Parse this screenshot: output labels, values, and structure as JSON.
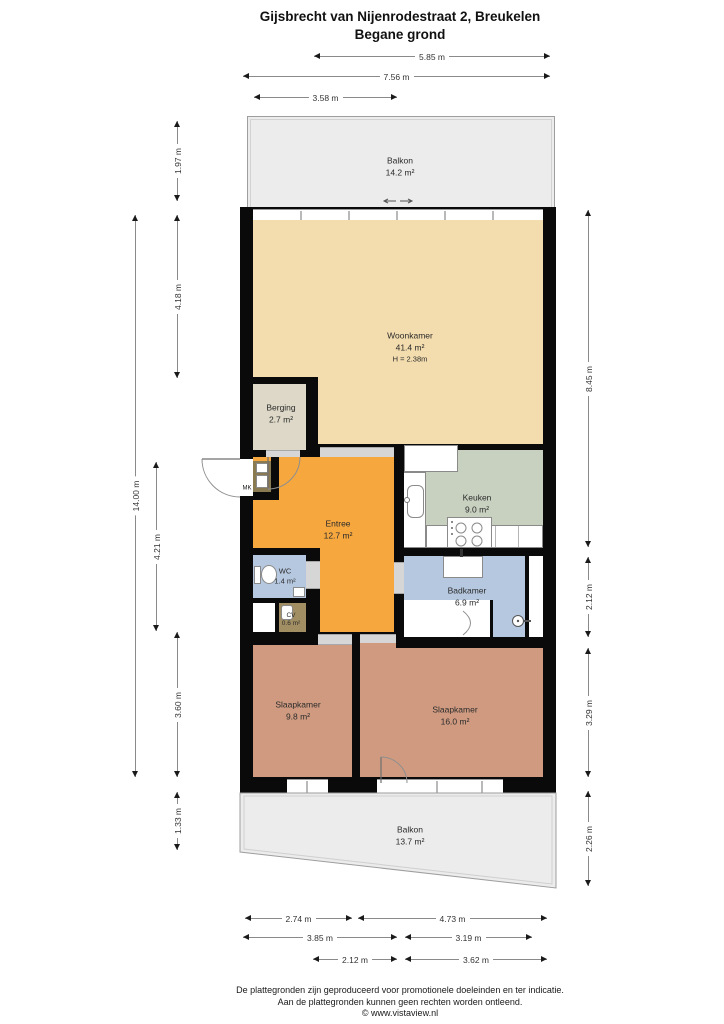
{
  "title": {
    "line1": "Gijsbrecht van Nijenrodestraat 2, Breukelen",
    "line2": "Begane grond"
  },
  "rooms": {
    "balkon_boven": {
      "name": "Balkon",
      "area": "14.2 m²"
    },
    "woonkamer": {
      "name": "Woonkamer",
      "area": "41.4 m²",
      "ceiling": "H = 2.38m"
    },
    "berging": {
      "name": "Berging",
      "area": "2.7 m²"
    },
    "keuken": {
      "name": "Keuken",
      "area": "9.0 m²"
    },
    "entree": {
      "name": "Entree",
      "area": "12.7 m²"
    },
    "wc": {
      "name": "WC",
      "area": "1.4 m²"
    },
    "cv": {
      "name": "CV",
      "area": "0.6 m²"
    },
    "badkamer": {
      "name": "Badkamer",
      "area": "6.9 m²"
    },
    "slaapkamer_links": {
      "name": "Slaapkamer",
      "area": "9.8 m²"
    },
    "slaapkamer_rechts": {
      "name": "Slaapkamer",
      "area": "16.0 m²"
    },
    "balkon_onder": {
      "name": "Balkon",
      "area": "13.7 m²"
    },
    "meterkast": {
      "label": "MK"
    }
  },
  "dims": {
    "top": [
      "5.85 m",
      "7.56 m",
      "3.58 m"
    ],
    "bottom": [
      "2.74 m",
      "4.73 m",
      "3.85 m",
      "3.19 m",
      "2.12 m",
      "3.62 m"
    ],
    "left": [
      "1.97 m",
      "4.18 m",
      "14.00 m",
      "4.21 m",
      "3.60 m",
      "1.33 m"
    ],
    "right": [
      "8.45 m",
      "2.12 m",
      "3.29 m",
      "2.26 m"
    ]
  },
  "footer": {
    "line1": "De plattegronden zijn geproduceerd voor promotionele doeleinden en ter indicatie.",
    "line2": "Aan de plattegronden kunnen geen rechten worden ontleend.",
    "line3": "© www.vistaview.nl"
  },
  "colors": {
    "wall": "#0a0a0a",
    "woonkamer": "#f3dcae",
    "entree": "#f6a73e",
    "keuken": "#c8d1c0",
    "badkamer": "#b6c8e0",
    "slaapkamer": "#cf9a80",
    "berging": "#ddd8c7",
    "cv": "#a18e63",
    "mk": "#8a7a52",
    "balkon": "#ececec"
  }
}
